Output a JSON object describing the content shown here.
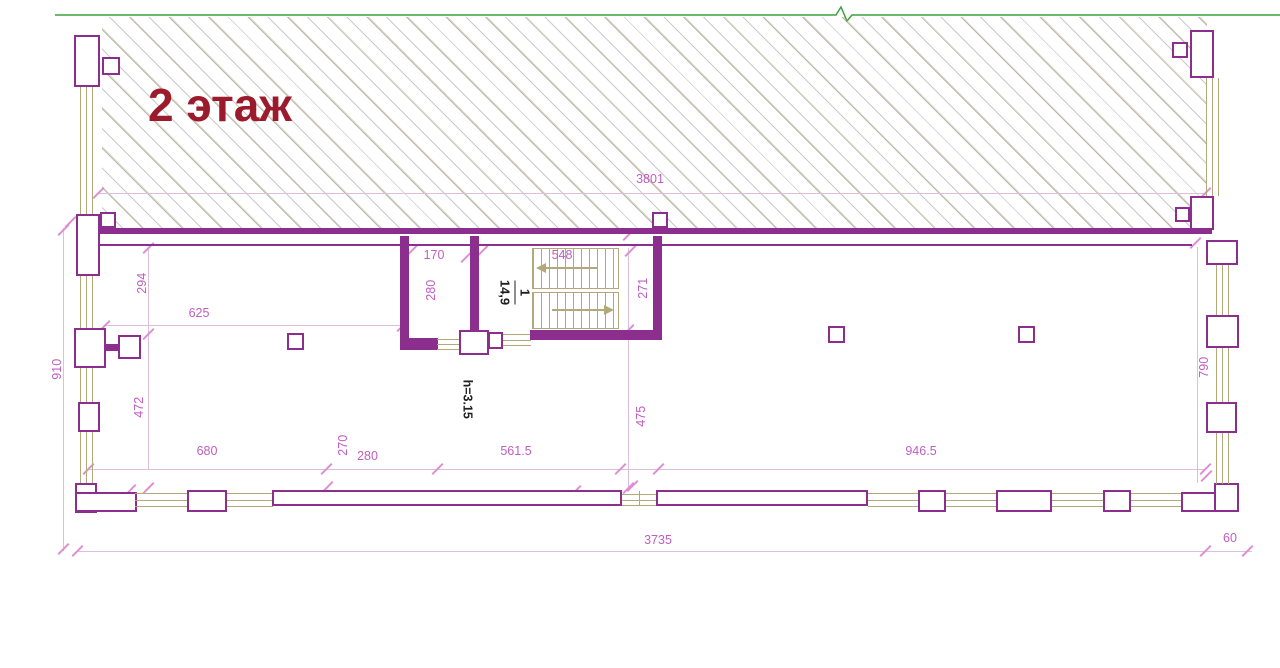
{
  "title": "2 этаж",
  "colors": {
    "wall": "#8b2e8d",
    "dim": "#c05ec0",
    "win": "#b3a87a",
    "tick": "#dd8fd3",
    "dimline": "#ddbedd",
    "green": "#3da23d",
    "title": "#9b1b2d"
  },
  "room": {
    "number": "1",
    "area": "14,9"
  },
  "annotations": {
    "ceiling_height": "h=3.15"
  },
  "dimensions": {
    "top_total": "3801",
    "bottom_total": "3735",
    "bottom_right_offset": "60",
    "left_outer_height": "910",
    "left_upper": "294",
    "left_lower": "472",
    "left_room_width": "625",
    "stair_anteroom_width": "170",
    "stair_anteroom_height": "280",
    "stair_flight_width": "548",
    "stair_upper_height": "271",
    "stair_lower_height": "475",
    "bottom_seg_1": "680",
    "bottom_seg_2": "270",
    "bottom_seg_3": "280",
    "bottom_seg_4": "561.5",
    "bottom_seg_5": "946.5",
    "right_inner_height": "790"
  }
}
